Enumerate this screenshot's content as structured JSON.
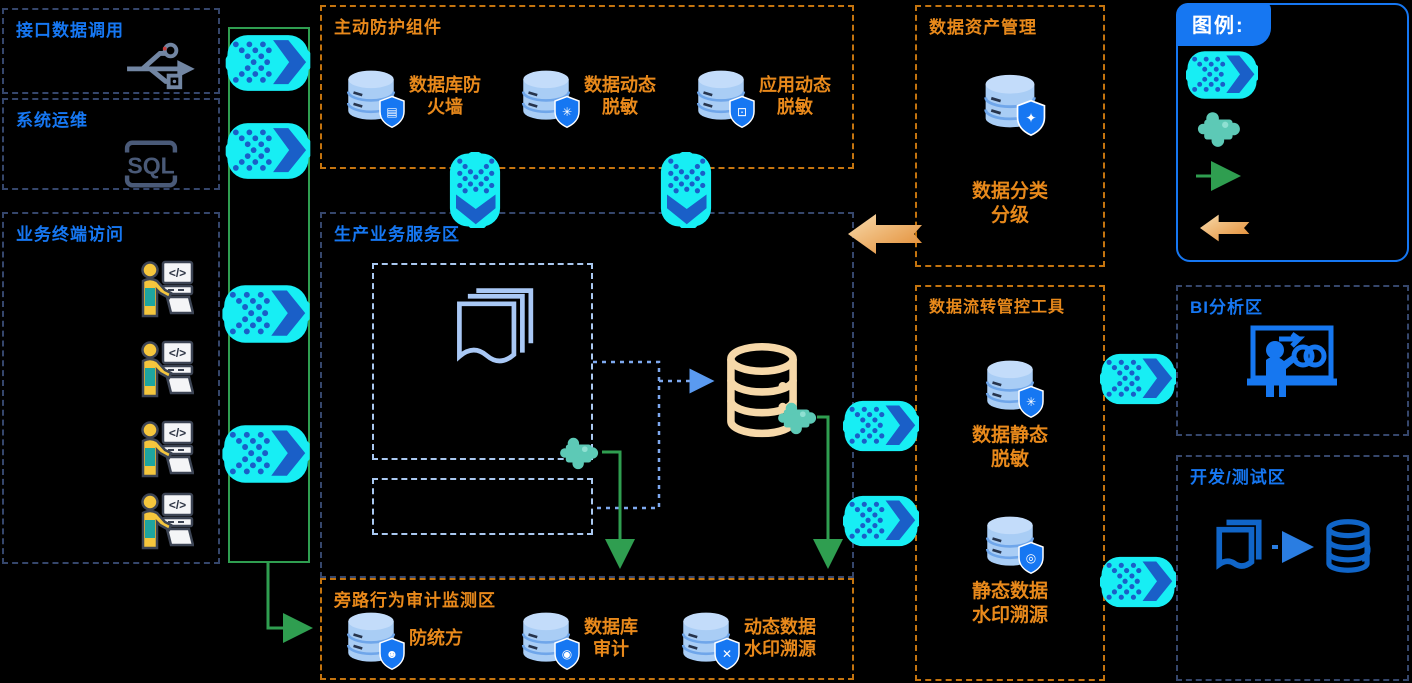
{
  "palette": {
    "background": "#000000",
    "blue_accent": "#1677f2",
    "orange_text": "#e8891b",
    "orange_border": "#c4740f",
    "dark_border": "#35466b",
    "inner_dashed": "#a9c8f0",
    "cyan_flow": "#17eef4",
    "chevron_blue": "#1a5fc8",
    "teal_puzzle": "#5dc9b6",
    "green_flow": "#2f9e50",
    "tan_database": "#f6d8a9",
    "db_fill": "#a9cdf5"
  },
  "zones": {
    "interface_call": {
      "title": "接口数据调用",
      "icon": "usb-icon"
    },
    "system_ops": {
      "title": "系统运维",
      "sql_label": "SQL"
    },
    "terminal_access": {
      "title": "业务终端访问",
      "workstation_count": "4",
      "code_glyph": "</>"
    },
    "active_protection": {
      "title": "主动防护组件",
      "items": [
        {
          "label": "数据库防\n火墙",
          "icon": "db-shield-firewall-icon",
          "glyph": "▤"
        },
        {
          "label": "数据动态\n脱敏",
          "icon": "db-shield-dynamic-mask-icon",
          "glyph": "✳"
        },
        {
          "label": "应用动态\n脱敏",
          "icon": "db-shield-app-mask-icon",
          "glyph": "⊡"
        }
      ]
    },
    "production": {
      "title": "生产业务服务区"
    },
    "bypass_audit": {
      "title": "旁路行为审计监测区",
      "items": [
        {
          "label": "防统方",
          "icon": "db-shield-person-icon",
          "glyph": "☻"
        },
        {
          "label": "数据库\n审计",
          "icon": "db-shield-audit-icon",
          "glyph": "◉"
        },
        {
          "label": "动态数据\n水印溯源",
          "icon": "db-shield-watermark-icon",
          "glyph": "✕"
        }
      ]
    },
    "data_asset": {
      "title": "数据资产管理",
      "item": {
        "label": "数据分类\n分级",
        "icon": "db-shield-classify-icon",
        "glyph": "✦"
      }
    },
    "flow_tools": {
      "title": "数据流转管控工具",
      "items": [
        {
          "label": "数据静态\n脱敏",
          "icon": "db-shield-static-mask-icon",
          "glyph": "✳"
        },
        {
          "label": "静态数据\n水印溯源",
          "icon": "db-shield-trace-icon",
          "glyph": "◎"
        }
      ]
    },
    "legend": {
      "title": "图例:",
      "items": [
        {
          "icon": "data-flow-arrow-icon"
        },
        {
          "icon": "plugin-puzzle-icon"
        },
        {
          "icon": "green-arrow-icon"
        },
        {
          "icon": "orange-arrow-icon"
        }
      ]
    },
    "bi": {
      "title": "BI分析区",
      "icon": "bi-presenter-icon"
    },
    "devtest": {
      "title": "开发/测试区",
      "icons": [
        "documents-icon",
        "database-icon"
      ]
    }
  }
}
